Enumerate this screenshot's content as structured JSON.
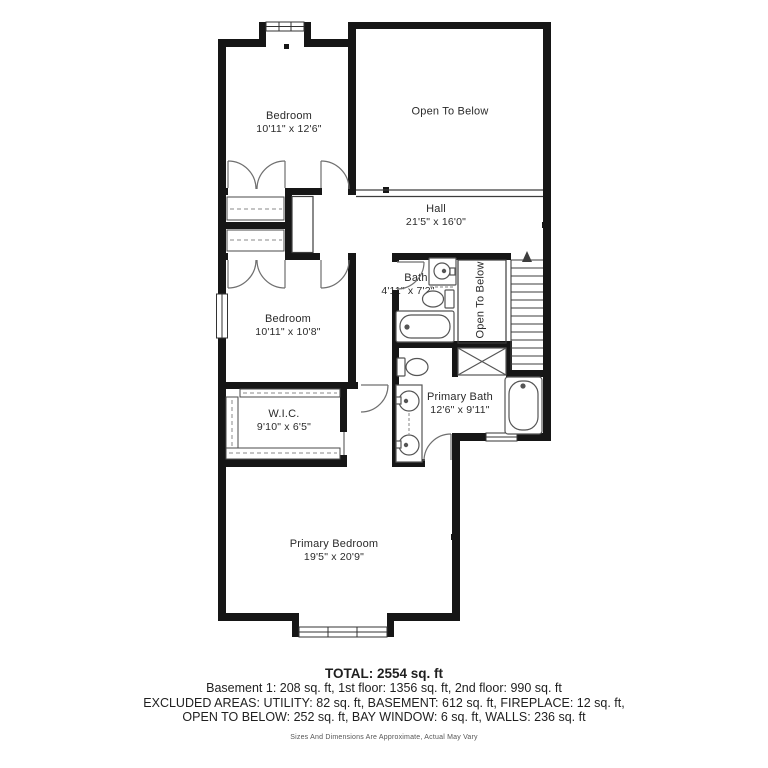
{
  "plan": {
    "rooms": {
      "bedroom1": {
        "name": "Bedroom",
        "dims": "10'11\" x 12'6\""
      },
      "open_below_top": {
        "name": "Open To Below"
      },
      "hall": {
        "name": "Hall",
        "dims": "21'5\" x 16'0\""
      },
      "bath": {
        "name": "Bath",
        "dims": "4'11\" x 7'2\""
      },
      "open_below_stair": {
        "name": "Open To Below"
      },
      "bedroom2": {
        "name": "Bedroom",
        "dims": "10'11\" x 10'8\""
      },
      "wic": {
        "name": "W.I.C.",
        "dims": "9'10\" x 6'5\""
      },
      "primary_bath": {
        "name": "Primary Bath",
        "dims": "12'6\" x 9'11\""
      },
      "primary_bedroom": {
        "name": "Primary Bedroom",
        "dims": "19'5\" x 20'9\""
      }
    },
    "summary": {
      "total": "TOTAL: 2554 sq. ft",
      "floors": "Basement 1: 208 sq. ft, 1st floor: 1356 sq. ft, 2nd floor: 990 sq. ft",
      "excluded1": "EXCLUDED AREAS: UTILITY: 82 sq. ft, BASEMENT: 612 sq. ft, FIREPLACE: 12 sq. ft,",
      "excluded2": "OPEN TO BELOW: 252 sq. ft, BAY WINDOW: 6 sq. ft, WALLS: 236 sq. ft",
      "disclaimer": "Sizes And Dimensions Are Approximate, Actual May Vary"
    }
  }
}
